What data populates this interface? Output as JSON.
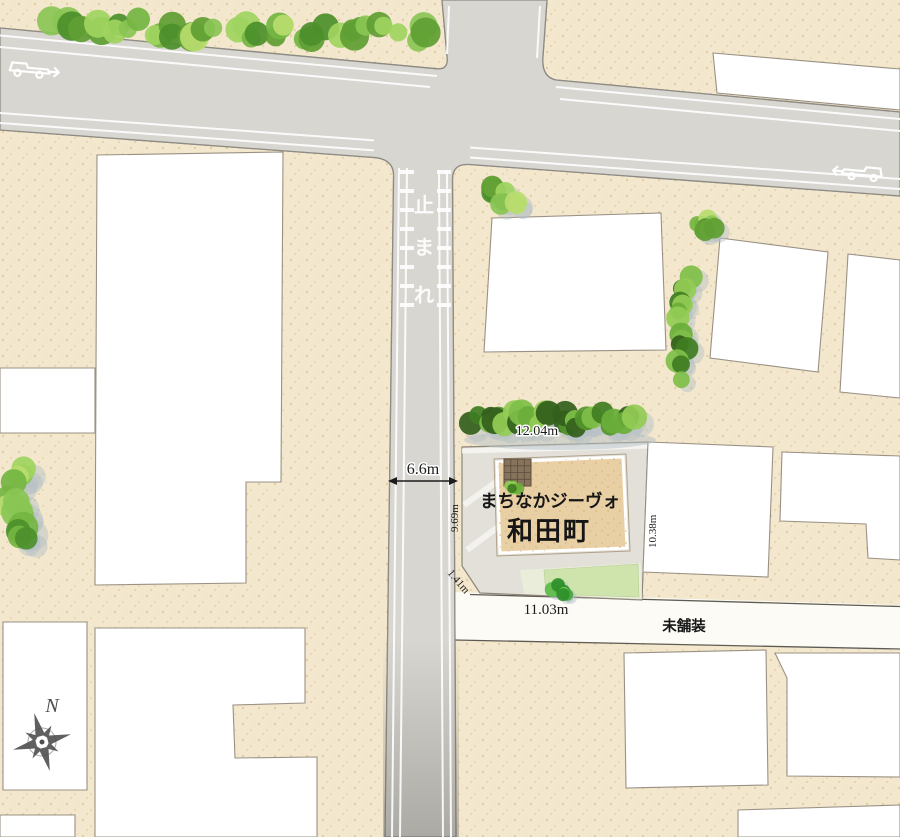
{
  "map": {
    "site": {
      "name_line1": "まちなかジーヴォ",
      "name_line2": "和田町"
    },
    "dimensions": {
      "road_width": "6.6m",
      "north_edge": "12.04m",
      "west_edge": "9.69m",
      "east_edge": "10.38m",
      "corner_cut": "1.41m",
      "south_edge": "11.03m"
    },
    "labels": {
      "unpaved_road": "未舗装",
      "compass_north": "N"
    },
    "road_marking": {
      "char1": "止",
      "char2": "ま",
      "char3": "れ"
    },
    "colors": {
      "paper_cream": "#f3e7cd",
      "road_gray": "#d8d6d0",
      "building_white": "#ffffff",
      "site_tan": "#e9cfa4",
      "tree_green": "#74b542",
      "lawn_green": "#cfe3ac"
    }
  }
}
